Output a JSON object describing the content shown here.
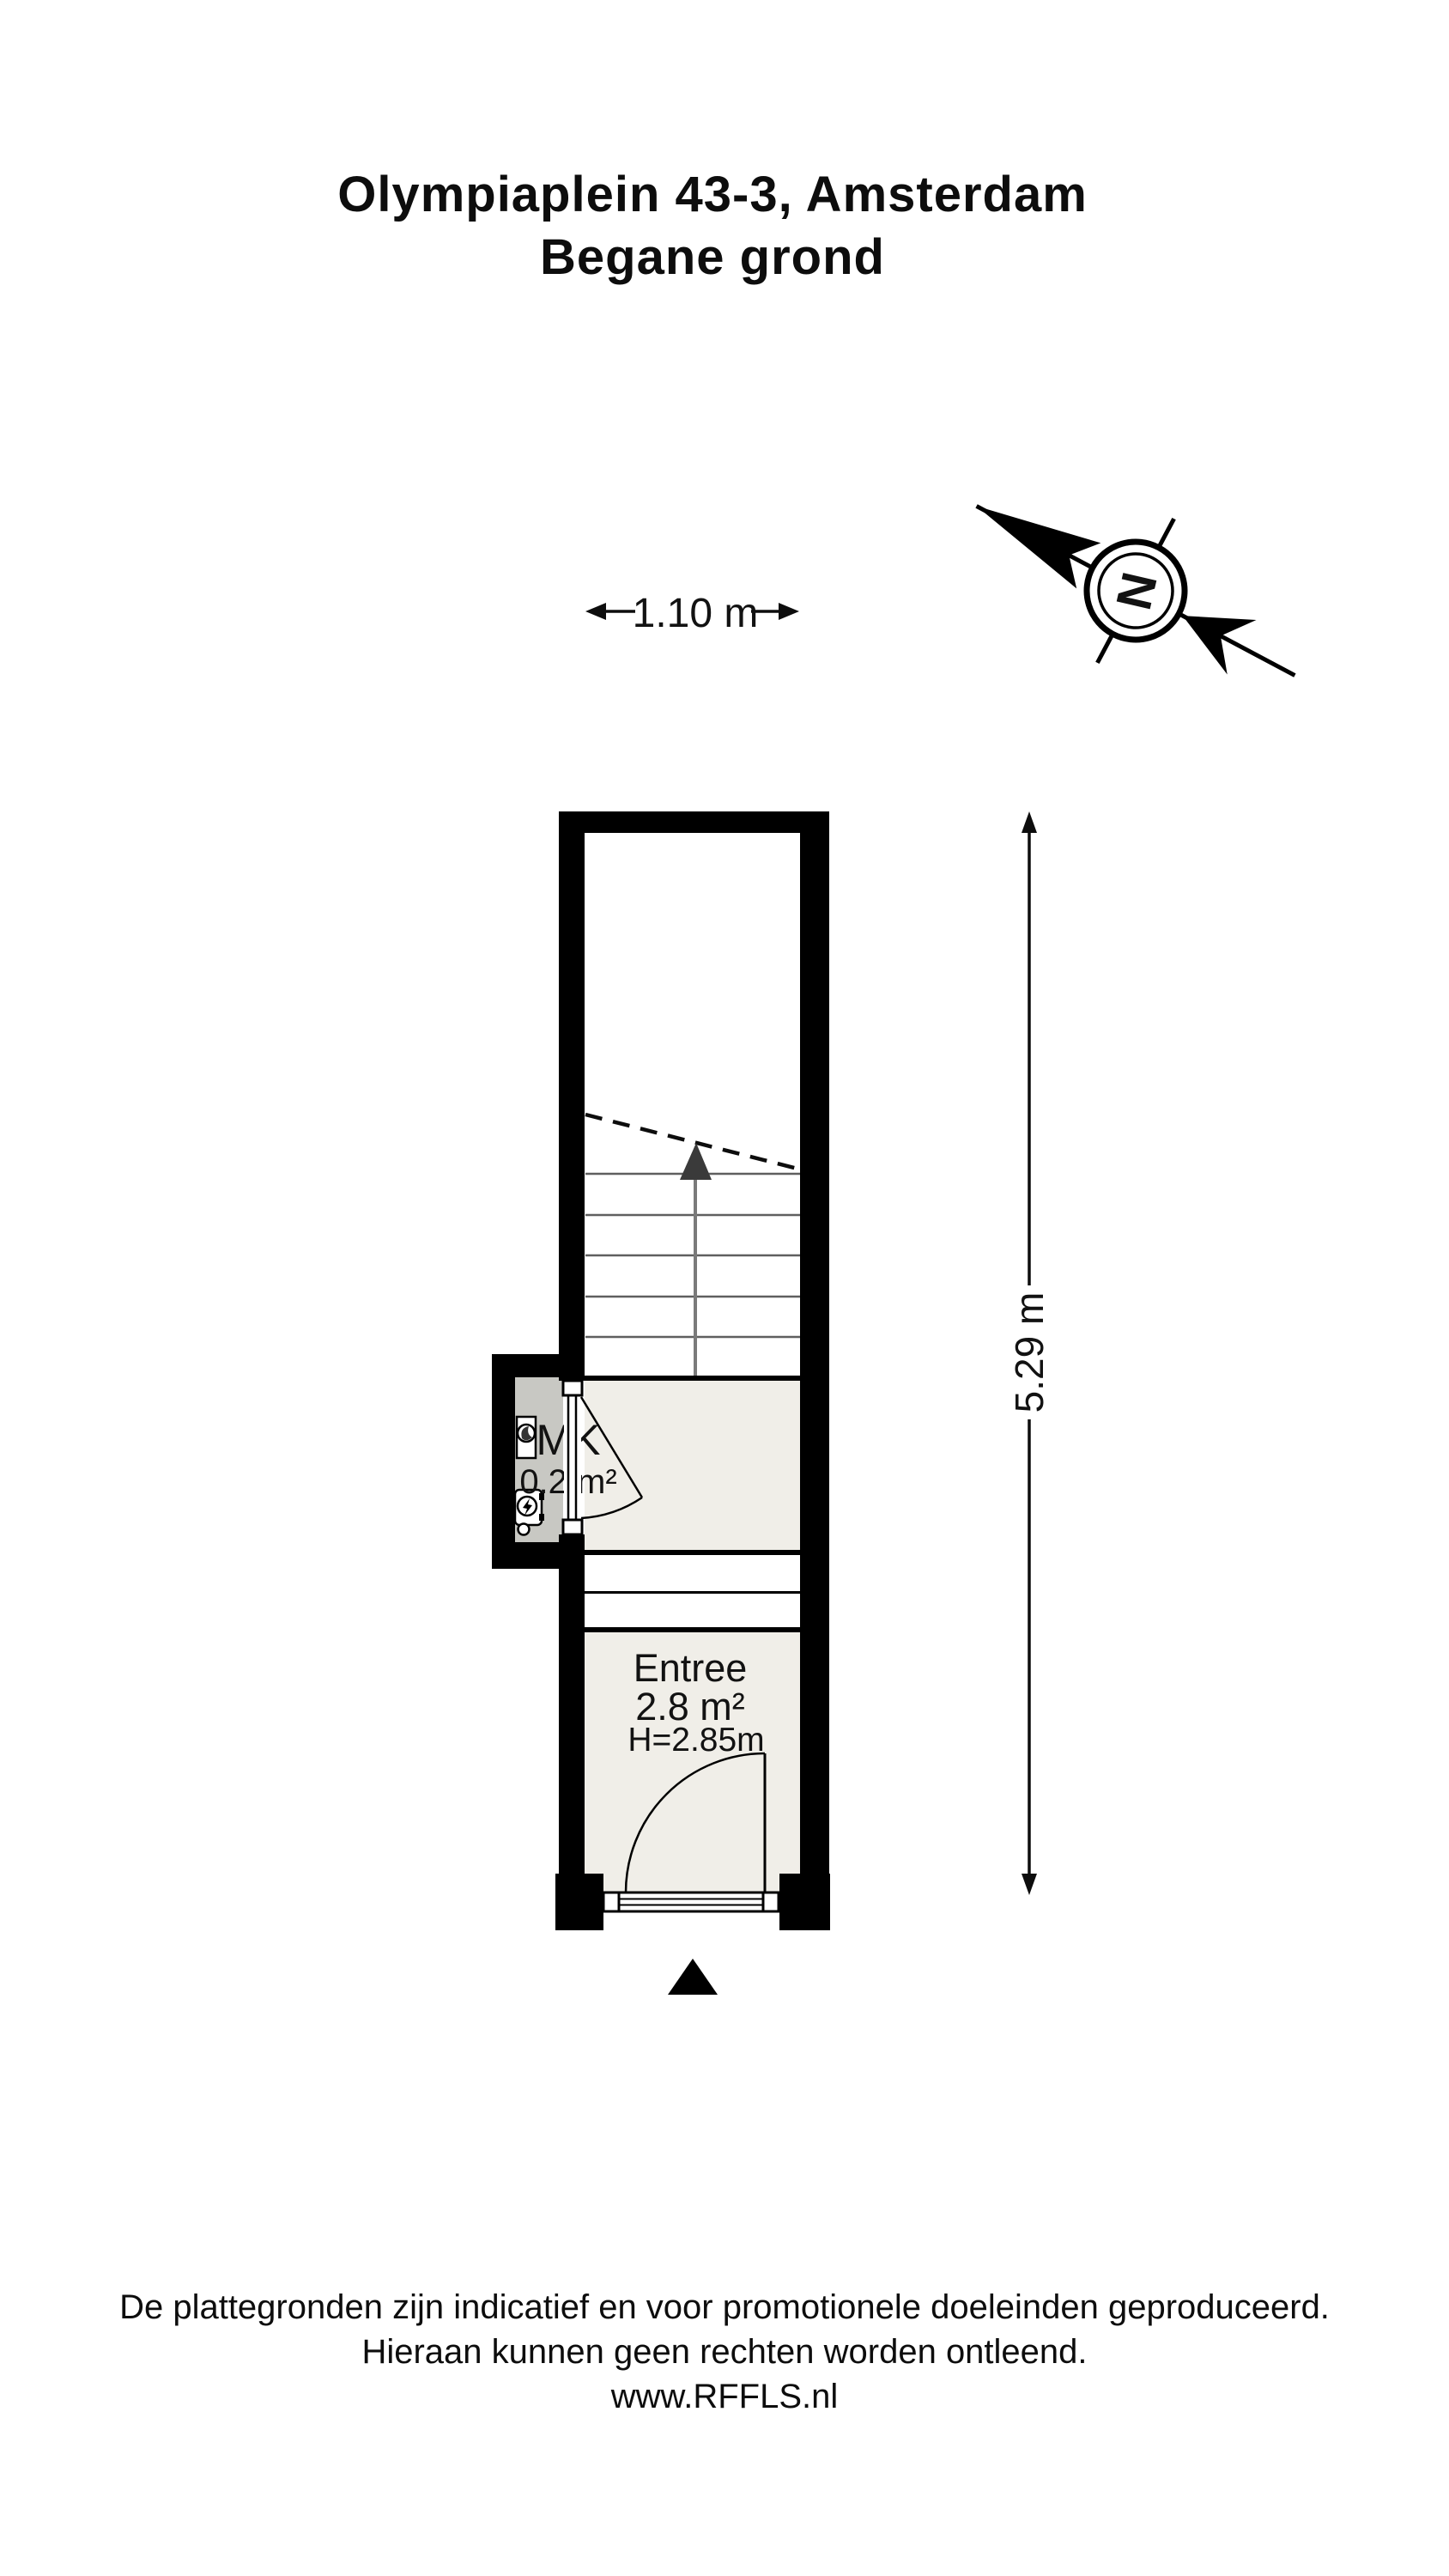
{
  "title": {
    "line1": "Olympiaplein 43-3, Amsterdam",
    "line2": "Begane grond"
  },
  "compass": {
    "label": "N"
  },
  "dimensions": {
    "width_label": "1.10 m",
    "height_label": "5.29 m"
  },
  "rooms": {
    "mk": {
      "name": "MK",
      "area": "0.2 m²"
    },
    "entree": {
      "name": "Entree",
      "area": "2.8 m²",
      "ceiling_height": "H=2.85m"
    }
  },
  "footer": {
    "line1": "De plattegronden zijn indicatief en voor promotionele doeleinden geproduceerd.",
    "line2": "Hieraan kunnen geen rechten worden ontleend.",
    "line3": "www.RFFLS.nl"
  },
  "colors": {
    "wall": "#000000",
    "floor_light": "#F0EEE8",
    "floor_mk": "#C8C8C3",
    "stair_tread": "#5f5f5f",
    "stair_center_line": "#7a7a7a",
    "stair_arrow": "#3a3a3a"
  }
}
